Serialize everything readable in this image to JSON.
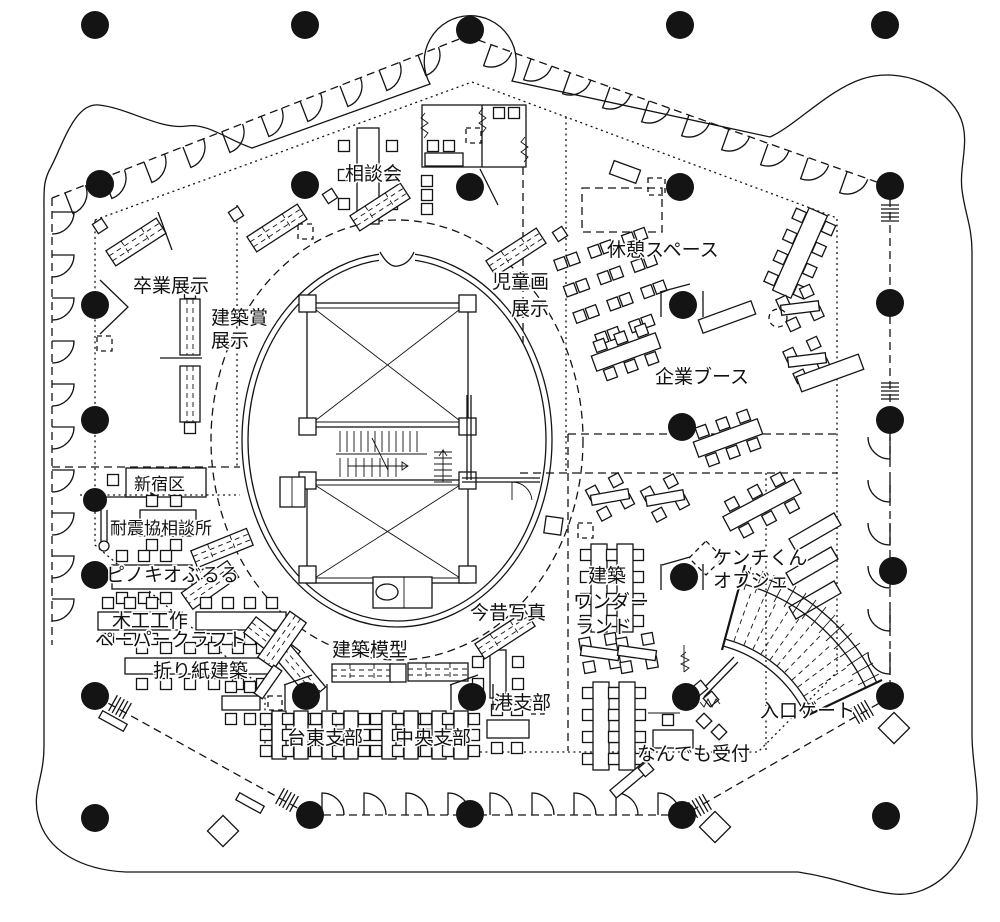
{
  "diagram": {
    "kind": "event-venue-floor-plan",
    "language": "ja",
    "ink_color": "#141414",
    "background_color": "#ffffff"
  },
  "labels": {
    "sodankai": "相談会",
    "jido_l1": "児童画",
    "jido_l2": "展示",
    "kyukei": "休憩スペース",
    "kigyo": "企業ブース",
    "sotsugyo": "卒業展示",
    "kenchikusho_l1": "建築賞",
    "kenchikusho_l2": "展示",
    "shinjuku": "新宿区",
    "taishin": "耐震協相談所",
    "pinocchio": "ピノキオぶるる",
    "mokko": "木工工作",
    "papercraft": "ペーパークラフト",
    "origami": "折り紙建築",
    "mokei": "建築模型",
    "konjaku": "今昔写真",
    "minato": "港支部",
    "taito": "台東支部",
    "chuo": "中央支部",
    "wonder_l1": "建築",
    "wonder_l2": "ワンダー",
    "wonder_l3": "ランド",
    "kenchikun_l1": "ケンチくん",
    "kenchikun_l2": "オブジェ",
    "gate": "入口ゲート",
    "uketsuke": "なんでも受付"
  }
}
